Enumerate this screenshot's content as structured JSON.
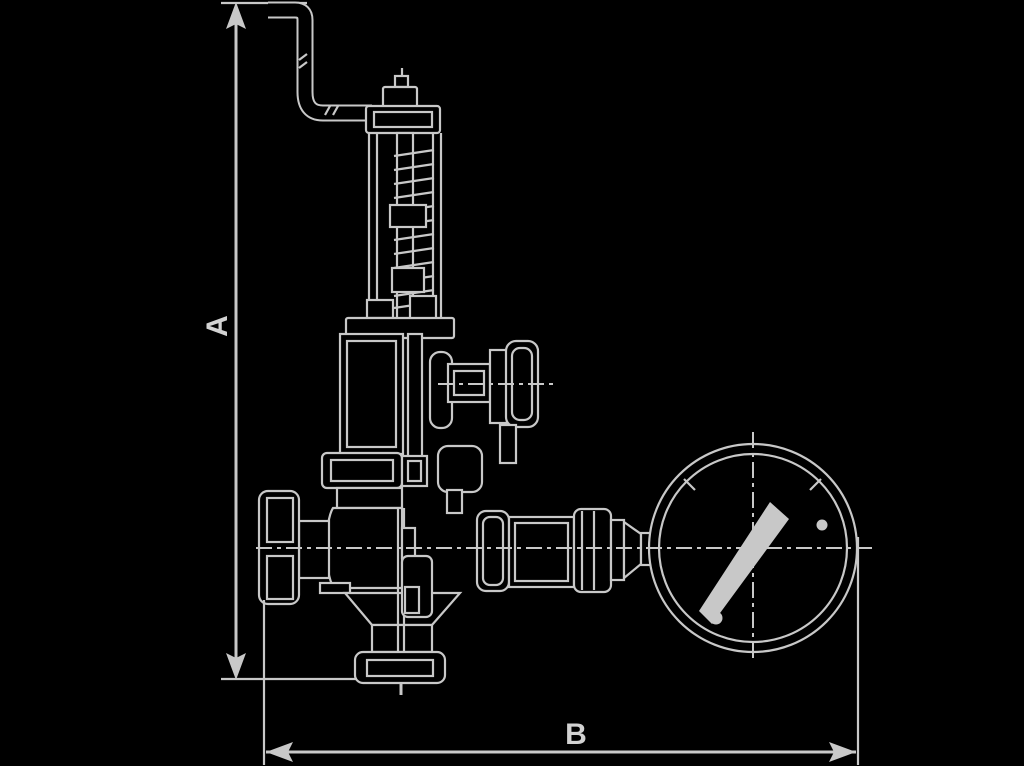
{
  "canvas": {
    "width": 1024,
    "height": 766,
    "background_color": "#000000",
    "line_color": "#c8c8c8"
  },
  "dimensions": {
    "a": {
      "label": "A",
      "orientation": "vertical",
      "measures": "overall valve height"
    },
    "b": {
      "label": "B",
      "orientation": "horizontal",
      "measures": "overall width from handwheel to gauge"
    }
  },
  "drawing": {
    "type": "technical line drawing",
    "subject": "safety relief valve with test lever, side handwheel and pressure gauge, side elevation",
    "parts": [
      "test-lever",
      "cap-pin",
      "bonnet-cap",
      "spring",
      "spring-spindle",
      "yoke-rods",
      "spring-seat-flange",
      "upper-body",
      "side-knob",
      "upper-flange",
      "valve-body",
      "handwheel",
      "drain-boss",
      "outlet-funnel",
      "base-flange",
      "gauge-union",
      "reducer-cone",
      "pressure-gauge",
      "gauge-needle",
      "gauge-dial-dots",
      "centerlines"
    ]
  }
}
